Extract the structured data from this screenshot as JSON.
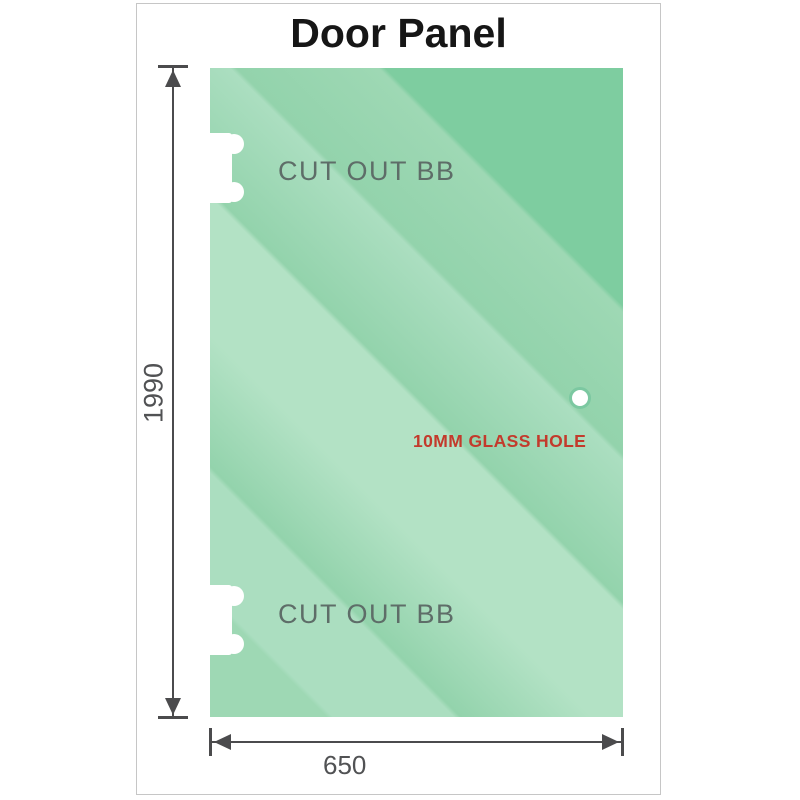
{
  "title": "Door Panel",
  "panel": {
    "height_label": "1990",
    "width_label": "650",
    "cutout_top_label": "CUT OUT BB",
    "cutout_bottom_label": "CUT OUT BB",
    "hole_label": "10MM GLASS HOLE"
  },
  "colors": {
    "glass_base": "#9ed8b4",
    "glass_light": "#b3e2c5",
    "glass_dark": "#7ecda0",
    "hole_ring": "#7cc8a1",
    "dimension_line": "#4b4b4d",
    "cutout_label_gray": "#5e6d68",
    "number_gray": "#515254",
    "hole_label_red": "#c33a2c",
    "frame_border": "#c6c6c6",
    "title_color": "#161616"
  }
}
